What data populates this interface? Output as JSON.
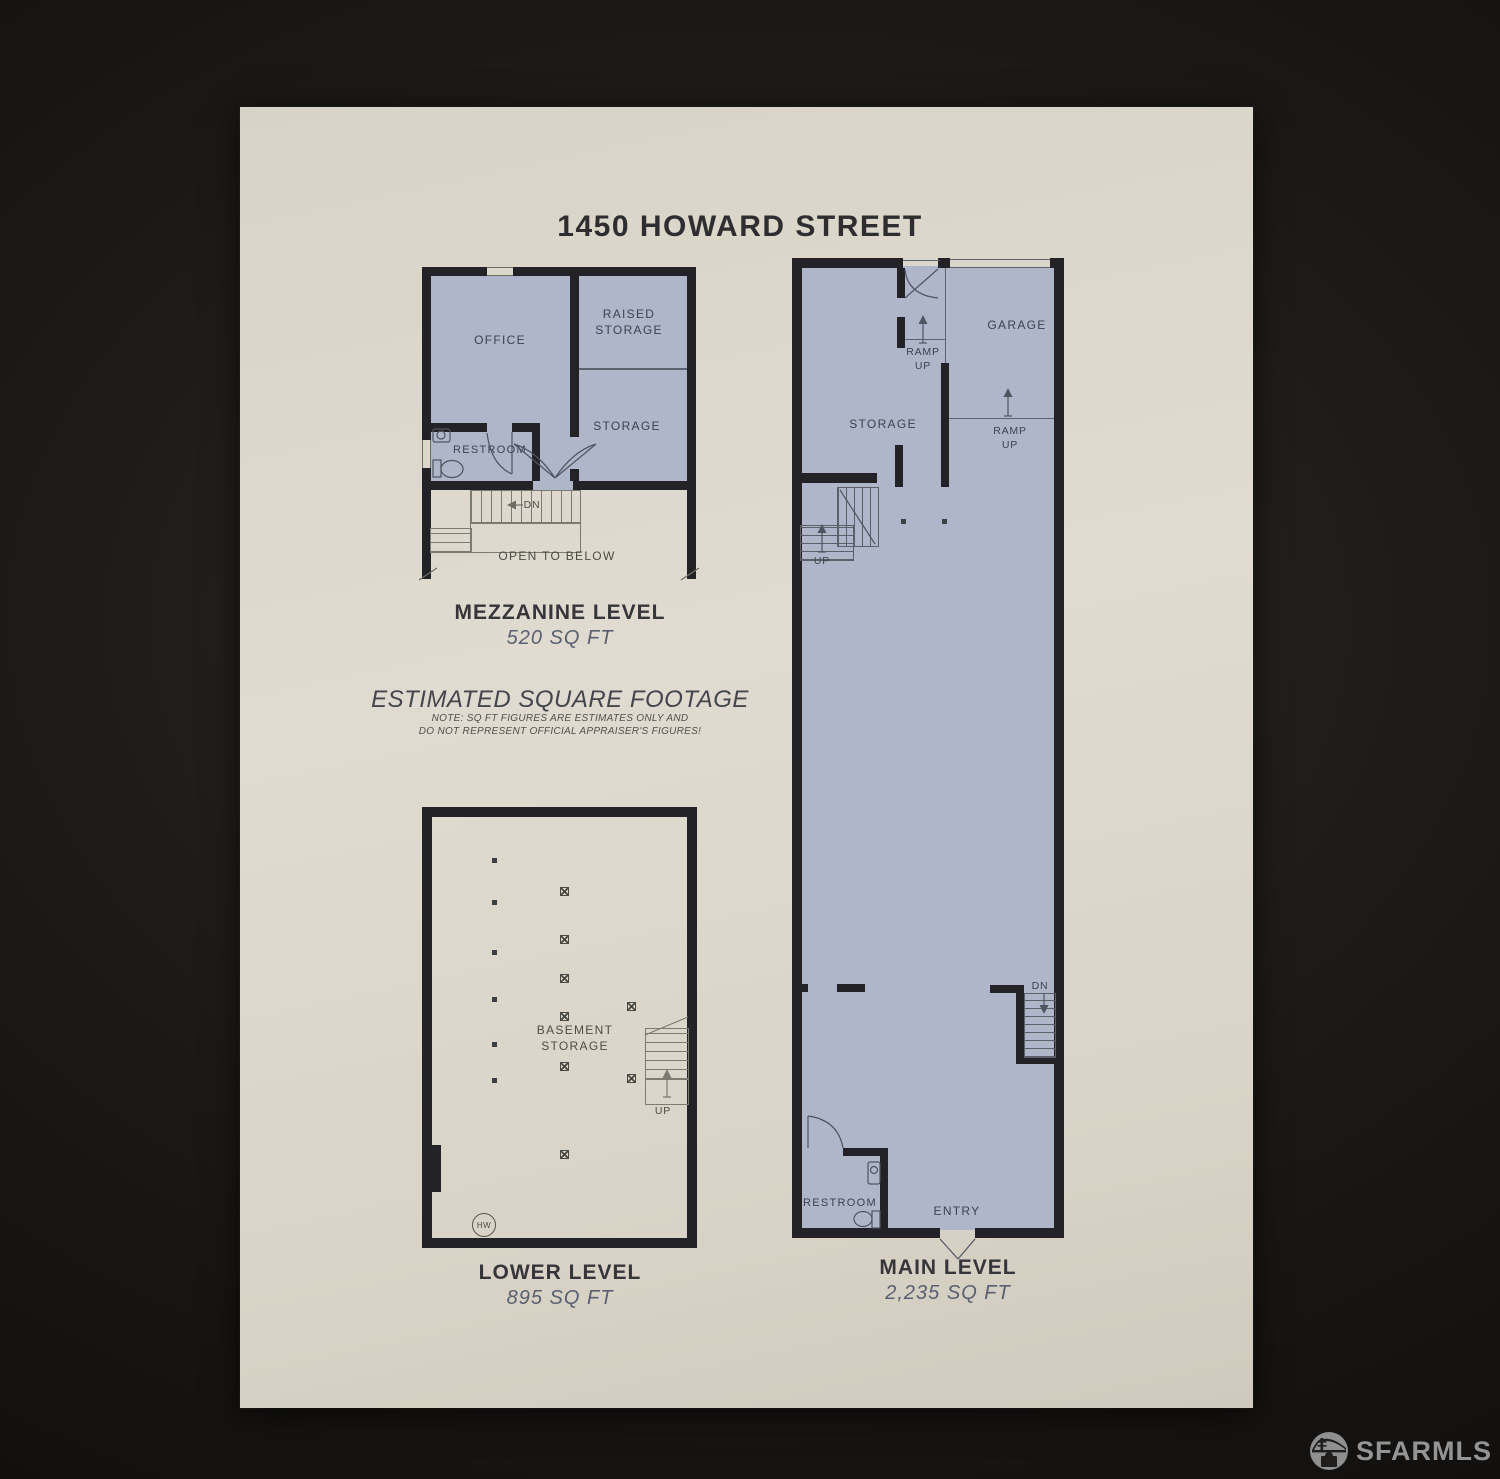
{
  "title": "1450 HOWARD STREET",
  "disclaimer": {
    "heading": "ESTIMATED SQUARE FOOTAGE",
    "note_line1": "NOTE: SQ FT FIGURES ARE ESTIMATES ONLY AND",
    "note_line2": "DO NOT REPRESENT OFFICIAL APPRAISER'S FIGURES!"
  },
  "floors": {
    "mezzanine": {
      "label": "MEZZANINE LEVEL",
      "area": "520 SQ FT",
      "rooms": {
        "office": "OFFICE",
        "raised_storage": "RAISED\nSTORAGE",
        "storage": "STORAGE",
        "restroom": "RESTROOM",
        "open_to_below": "OPEN TO BELOW"
      },
      "annotations": {
        "stairs_down": "DN"
      }
    },
    "lower": {
      "label": "LOWER LEVEL",
      "area": "895 SQ FT",
      "rooms": {
        "basement_storage": "BASEMENT\nSTORAGE"
      },
      "annotations": {
        "stairs_up": "UP",
        "water_heater": "HW"
      }
    },
    "main": {
      "label": "MAIN LEVEL",
      "area": "2,235 SQ FT",
      "rooms": {
        "garage": "GARAGE",
        "storage": "STORAGE",
        "restroom": "RESTROOM",
        "entry": "ENTRY"
      },
      "annotations": {
        "ramp_up_front": "RAMP\nUP",
        "ramp_up_garage": "RAMP\nUP",
        "stairs_up": "UP",
        "stairs_down": "DN"
      }
    }
  },
  "watermark": {
    "brand": "SFARMLS"
  },
  "colors": {
    "background": "#151311",
    "paper": "#dcd7cb",
    "floor_fill": "#b0b6c9",
    "wall": "#232226",
    "accent_text": "#59606f"
  }
}
